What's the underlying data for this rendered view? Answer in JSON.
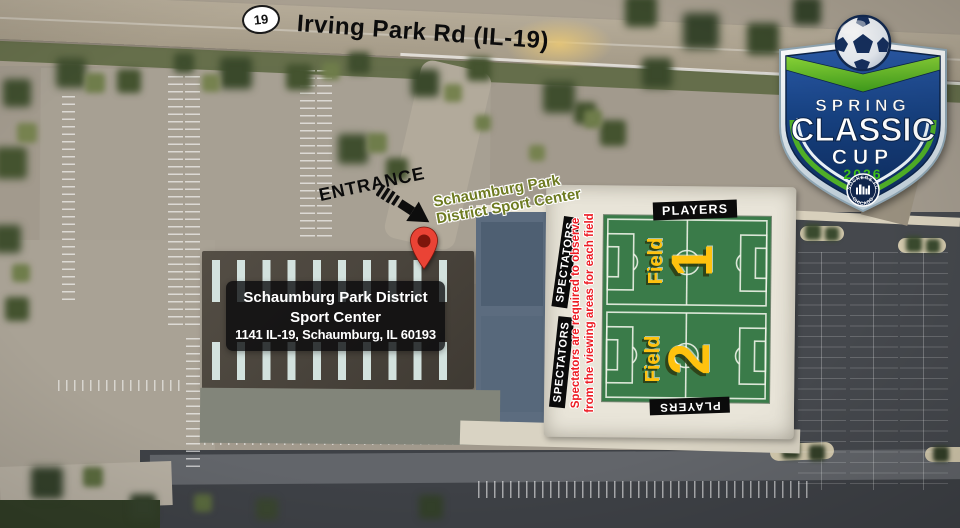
{
  "colors": {
    "field-green": "#3a7b49",
    "field-yellow": "#ffc20e",
    "warning-red": "#ed1c24",
    "pin-red": "#ea4335",
    "label-olive": "#6e7b21",
    "logo-navy": "#16407f",
    "logo-green": "#55b52c"
  },
  "map": {
    "route_shield": "19",
    "road_label": "Irving Park Rd (IL-19)",
    "entrance_label": "ENTRANCE",
    "pin": {
      "line1": "Schaumburg Park",
      "line2": "District Sport Center"
    },
    "address": {
      "line1": "Schaumburg Park District",
      "line2": "Sport Center",
      "line3": "1141 IL-19, Schaumburg, IL 60193"
    },
    "players_top": "PLAYERS",
    "players_bottom": "PLAYERS",
    "spectators_field1": "SPECTATORS",
    "spectators_field2": "SPECTATORS",
    "warning": {
      "line1": "Spectators are required to observe",
      "line2": "from the viewing areas for each field"
    },
    "fields": [
      {
        "label": "Field",
        "number": "1"
      },
      {
        "label": "Field",
        "number": "2"
      }
    ]
  },
  "logo": {
    "spring": "SPRING",
    "classic": "CLASSIC",
    "cup": "CUP",
    "year": "2026",
    "badge_top": "SOCKERS FC",
    "badge_bottom": "CHICAGO"
  }
}
